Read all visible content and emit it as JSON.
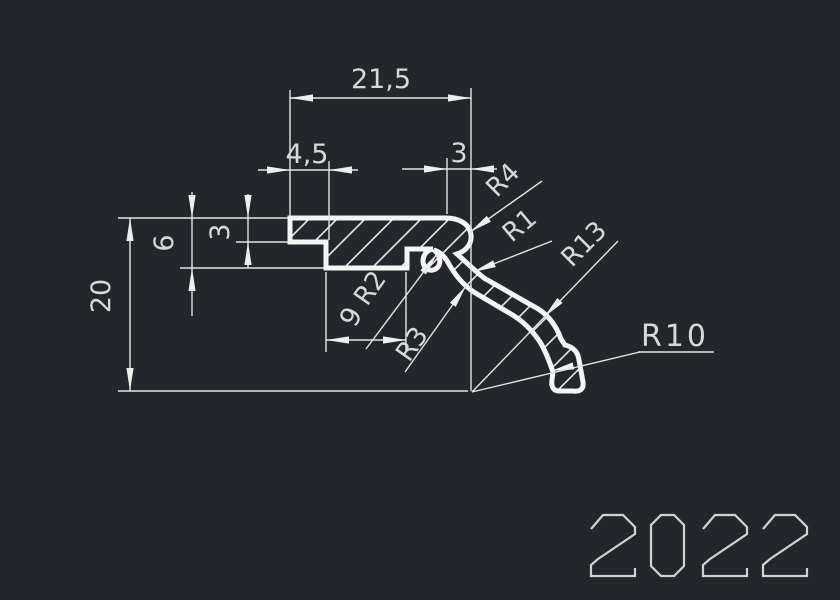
{
  "canvas": {
    "background": "#23272c",
    "profile_color": "#f5f5f5",
    "dim_line_color": "#e4e4e4",
    "text_color": "#d8d8d8"
  },
  "dimensions": {
    "total_width": "21,5",
    "step_width": "4,5",
    "right_width": "3",
    "total_height": "20",
    "web_height": "6",
    "lip_height": "3",
    "notch_width": "9"
  },
  "radii": {
    "r4": "R4",
    "r1": "R1",
    "r13": "R13",
    "r2": "R2",
    "r3": "R3",
    "r10": "R10"
  },
  "part_number": "2022"
}
